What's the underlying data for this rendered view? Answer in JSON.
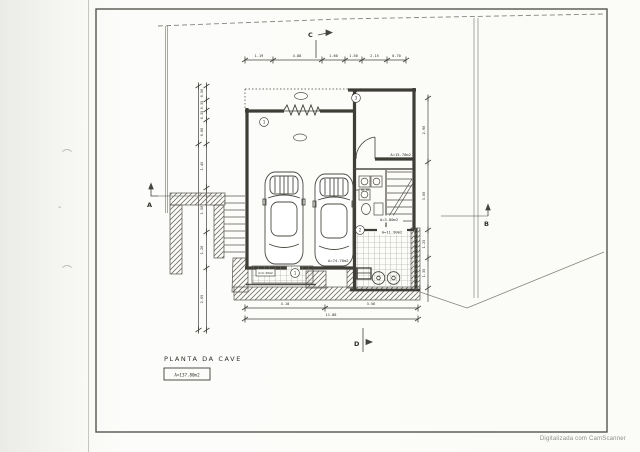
{
  "document": {
    "title": "PLANTA DA CAVE",
    "title_area": "A=137.80m2",
    "watermark": "Digitalizada com CamScanner"
  },
  "section_markers": {
    "top": "C",
    "left": "A",
    "right": "B",
    "bottom": "D"
  },
  "rooms": {
    "garage_area": "A=74.70m2",
    "storage_area": "A=15.70m2",
    "stair_hall_area": "A=3.80m2",
    "laundry_area": "A=11.90m2",
    "porch_area": "A=4.50m2"
  },
  "callouts": {
    "garage": "1",
    "storage": "3",
    "laundry": "2",
    "porch": "1"
  },
  "dimensions": {
    "top": [
      "1.19",
      "4.88",
      "1.60",
      "1.50",
      "2.15",
      "0.70"
    ],
    "bottom_segments": [
      "4.10",
      "3.56"
    ],
    "bottom_total": "11.88",
    "left": [
      "0.50",
      "0.35",
      "0.35",
      "0.80",
      "1.45",
      "1.50",
      "1.20",
      "2.05"
    ],
    "right": [
      "2.90",
      "3.00",
      "1.25",
      "1.35"
    ]
  }
}
